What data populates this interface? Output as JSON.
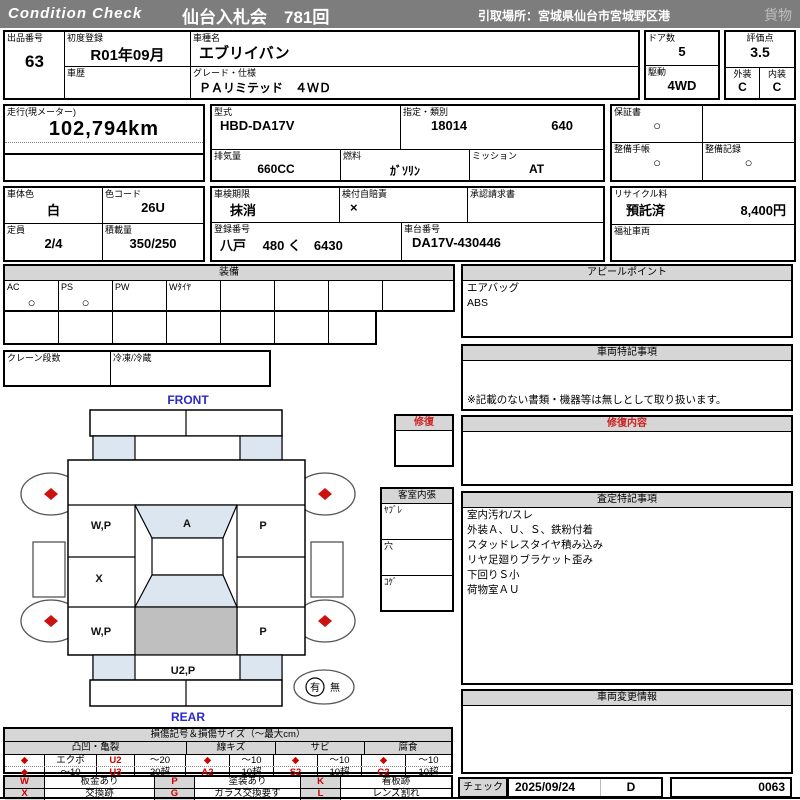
{
  "header": {
    "brand": "Condition  Check",
    "title": "仙台入札会　781回",
    "pickup": "引取場所：宮城県仙台市宮城野区港",
    "category": "貨物"
  },
  "info": {
    "lot_label": "出品番号",
    "lot": "63",
    "first_reg_label": "初度登録",
    "first_reg": "R01年09月",
    "history_label": "車歴",
    "history": "",
    "model_name_label": "車種名",
    "model_name": "エブリイバン",
    "grade_label": "グレード・仕様",
    "grade": "ＰＡリミテッド　４ＷＤ",
    "doors_label": "ドア数",
    "doors": "5",
    "drive_label": "駆動",
    "drive": "4WD",
    "score_label": "評価点",
    "score": "3.5",
    "exterior_label": "外装",
    "exterior": "C",
    "interior_label": "内装",
    "interior": "C",
    "mileage_label": "走行(現メーター)",
    "mileage": "102,794km",
    "model_code_label": "型式",
    "model_code": "HBD-DA17V",
    "type_class_label": "指定・類別",
    "type_no": "18014",
    "class_no": "640",
    "warranty_label": "保証書",
    "warranty": "○",
    "displacement_label": "排気量",
    "displacement": "660CC",
    "fuel_label": "燃料",
    "fuel": "ｶﾞｿﾘﾝ",
    "transmission_label": "ミッション",
    "transmission": "AT",
    "maintenance_book_label": "整備手帳",
    "maintenance_book": "○",
    "maintenance_record_label": "整備記録",
    "maintenance_record": "○",
    "body_color_label": "車体色",
    "body_color": "白",
    "color_code_label": "色コード",
    "color_code": "26U",
    "inspection_label": "車検期限",
    "inspection": "抹消",
    "insurance_label": "検付自賠責",
    "insurance": "×",
    "approval_label": "承認請求書",
    "approval": "",
    "recycle_label": "リサイクル料",
    "recycle_status": "預託済",
    "recycle_fee": "8,400円",
    "capacity_label": "定員",
    "capacity": "2/4",
    "load_label": "積載量",
    "load": "350/250",
    "reg_no_label": "登録番号",
    "reg_no": "八戸　 480 く　6430",
    "chassis_label": "車台番号",
    "chassis": "DA17V-430446",
    "welfare_label": "福祉車両",
    "welfare": ""
  },
  "equipment": {
    "title": "装備",
    "items": [
      {
        "label": "AC",
        "value": "○"
      },
      {
        "label": "PS",
        "value": "○"
      },
      {
        "label": "PW",
        "value": ""
      },
      {
        "label": "Wﾀｲﾔ",
        "value": ""
      },
      {
        "label": "",
        "value": ""
      },
      {
        "label": "",
        "value": ""
      },
      {
        "label": "",
        "value": ""
      },
      {
        "label": "",
        "value": ""
      }
    ],
    "crane_label": "クレーン段数",
    "crane_value": "",
    "fridge_label": "冷凍/冷蔵",
    "fridge_value": ""
  },
  "repair_box": {
    "title": "修復",
    "content": ""
  },
  "trim": {
    "title": "客室内張",
    "rows": [
      "ﾔﾌﾞﾚ",
      "穴",
      "ｺｹﾞ"
    ]
  },
  "diagram": {
    "front": "FRONT",
    "rear": "REAR",
    "marks": {
      "lf_door": "W,P",
      "windshield": "A",
      "rf_door": "P",
      "l_slide": "X",
      "lr_quarter": "W,P",
      "rr_quarter": "P",
      "rear_gate": "U2,P"
    },
    "spare": {
      "yes": "有",
      "no": "無"
    }
  },
  "appeal": {
    "title": "アピールポイント",
    "lines": [
      "エアバッグ",
      "ABS"
    ]
  },
  "vehicle_notes": {
    "title": "車両特記事項",
    "note": "※記載のない書類・機器等は無しとして取り扱います。"
  },
  "repair_details": {
    "title": "修復内容",
    "content": ""
  },
  "assessment": {
    "title": "査定特記事項",
    "lines": [
      "室内汚れ/スレ",
      "外装Ａ、Ｕ、Ｓ、鉄粉付着",
      "スタッドレスタイヤ積み込み",
      "リヤ足廻りブラケット歪み",
      "下回りＳ小",
      "荷物室ＡＵ"
    ]
  },
  "change_info": {
    "title": "車両変更情報",
    "content": ""
  },
  "check": {
    "label": "チェック",
    "date": "2025/09/24",
    "grade": "D",
    "number": "0063"
  },
  "legend": {
    "title": "損傷記号＆損傷サイズ（～最大cm）",
    "groups": [
      {
        "name": "凸凹・亀裂",
        "rows": [
          [
            "◆",
            "エクボ",
            "U2",
            "～20"
          ],
          [
            "◆",
            "～10",
            "U3",
            "20超"
          ]
        ]
      },
      {
        "name": "線キズ",
        "rows": [
          [
            "◆",
            "～10"
          ],
          [
            "A2",
            "10超"
          ]
        ]
      },
      {
        "name": "サビ",
        "rows": [
          [
            "◆",
            "～10"
          ],
          [
            "S2",
            "10超"
          ]
        ]
      },
      {
        "name": "腐食",
        "rows": [
          [
            "◆",
            "～10"
          ],
          [
            "C2",
            "10超"
          ]
        ]
      }
    ],
    "codes": [
      {
        "code": "W",
        "desc": "板金あり"
      },
      {
        "code": "P",
        "desc": "塗装あり"
      },
      {
        "code": "K",
        "desc": "看板跡"
      },
      {
        "code": "X",
        "desc": "交換跡"
      },
      {
        "code": "G",
        "desc": "ガラス交換要す"
      },
      {
        "code": "L",
        "desc": "レンズ割れ"
      }
    ],
    "colors": {
      "accent_red": "#cc0000",
      "label_blue": "#2929c8",
      "window_blue": "#dce6f1",
      "panel_gray": "#bfbfbf"
    }
  }
}
